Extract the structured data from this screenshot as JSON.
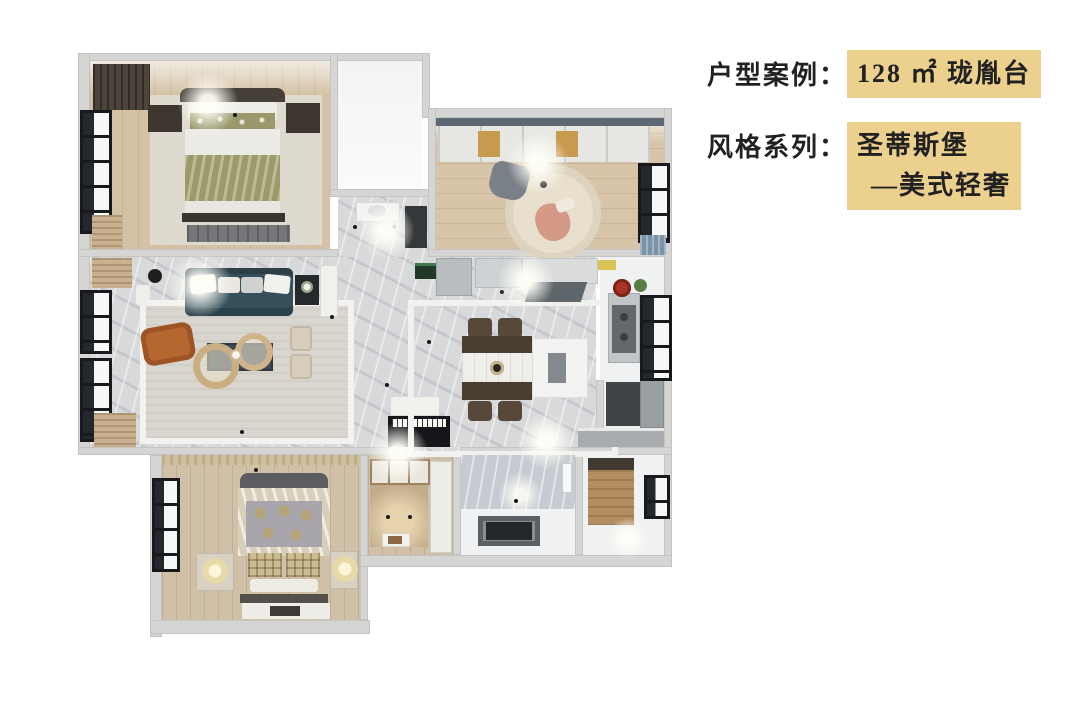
{
  "caption": {
    "line1": {
      "label": "户型案例：",
      "value": "128 ㎡ 珑胤台"
    },
    "line2": {
      "label": "风格系列：",
      "value_line1": "圣蒂斯堡",
      "value_line2": "—美式轻奢"
    },
    "highlight_color": "#ecd08d",
    "text_color": "#212121"
  },
  "floorplan_colors": {
    "wall": "#d5d5d3",
    "marble_floor": "#d8d9db",
    "wood_floor": "#d5c2a6",
    "white_floor": "#f0f1f2",
    "sofa_teal": "#35505b",
    "armchair_orange": "#b4672f",
    "bed_blanket_olive": "#a5a470",
    "gold_table": "#c9ae82",
    "bathtub_dark": "#24282c",
    "red_plate": "#a83425",
    "curtain_blue": "#7b93a9"
  }
}
